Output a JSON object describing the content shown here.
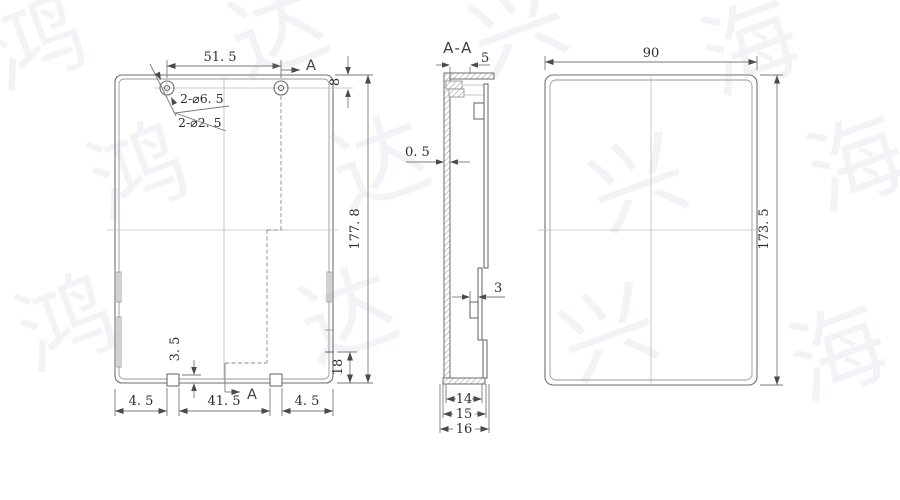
{
  "drawing": {
    "front_view": {
      "dim_hole_spacing": "51. 5",
      "dim_hole_top_offset": "8",
      "dim_overall_height": "177. 8",
      "dim_side_feature": "18",
      "dim_tab_height": "3. 5",
      "dim_bottom_left": "4. 5",
      "dim_bottom_middle": "41. 5",
      "dim_bottom_right": "4. 5",
      "callout_holes_outer": "2-⌀6. 5",
      "callout_holes_inner": "2-⌀2. 5",
      "section_arrow_top": "A",
      "section_arrow_bottom": "A"
    },
    "section_view": {
      "title": "A-A",
      "dim_flange": "5",
      "dim_wall_thickness": "0. 5",
      "dim_clip": "3",
      "dim_width_inner": "14",
      "dim_width_mid": "15",
      "dim_width_outer": "16"
    },
    "side_view": {
      "dim_width": "90",
      "dim_height": "173. 5"
    }
  },
  "watermark": {
    "chars": [
      "鸿",
      "达",
      "兴",
      "海",
      "鸿",
      "达",
      "兴",
      "海",
      "鸿",
      "达",
      "兴",
      "海"
    ]
  }
}
